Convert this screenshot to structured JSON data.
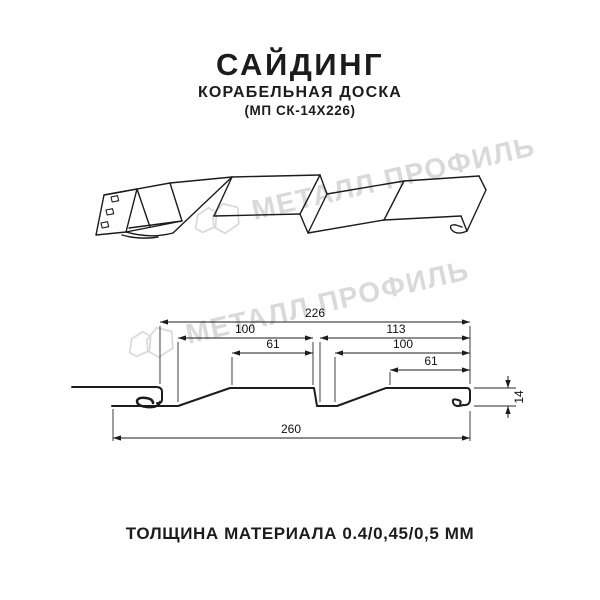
{
  "header": {
    "title": "САЙДИНГ",
    "subtitle": "КОРАБЕЛЬНАЯ ДОСКА",
    "model": "(МП СК-14Х226)"
  },
  "watermark": {
    "text": "МЕТАЛЛ ПРОФИЛЬ",
    "color": "#d9d9d9"
  },
  "section_dims": {
    "overall_top": "226",
    "upper_left": "100",
    "upper_right": "113",
    "inner_left": "61",
    "inner_right": "100",
    "small_right": "61",
    "overall_bottom": "260",
    "height": "14"
  },
  "footer": {
    "thickness_label": "ТОЛЩИНА МАТЕРИАЛА 0.4/0,45/0,5 ММ"
  },
  "colors": {
    "line": "#1c1c1c",
    "dimension": "#000000",
    "watermark": "#d9d9d9"
  }
}
